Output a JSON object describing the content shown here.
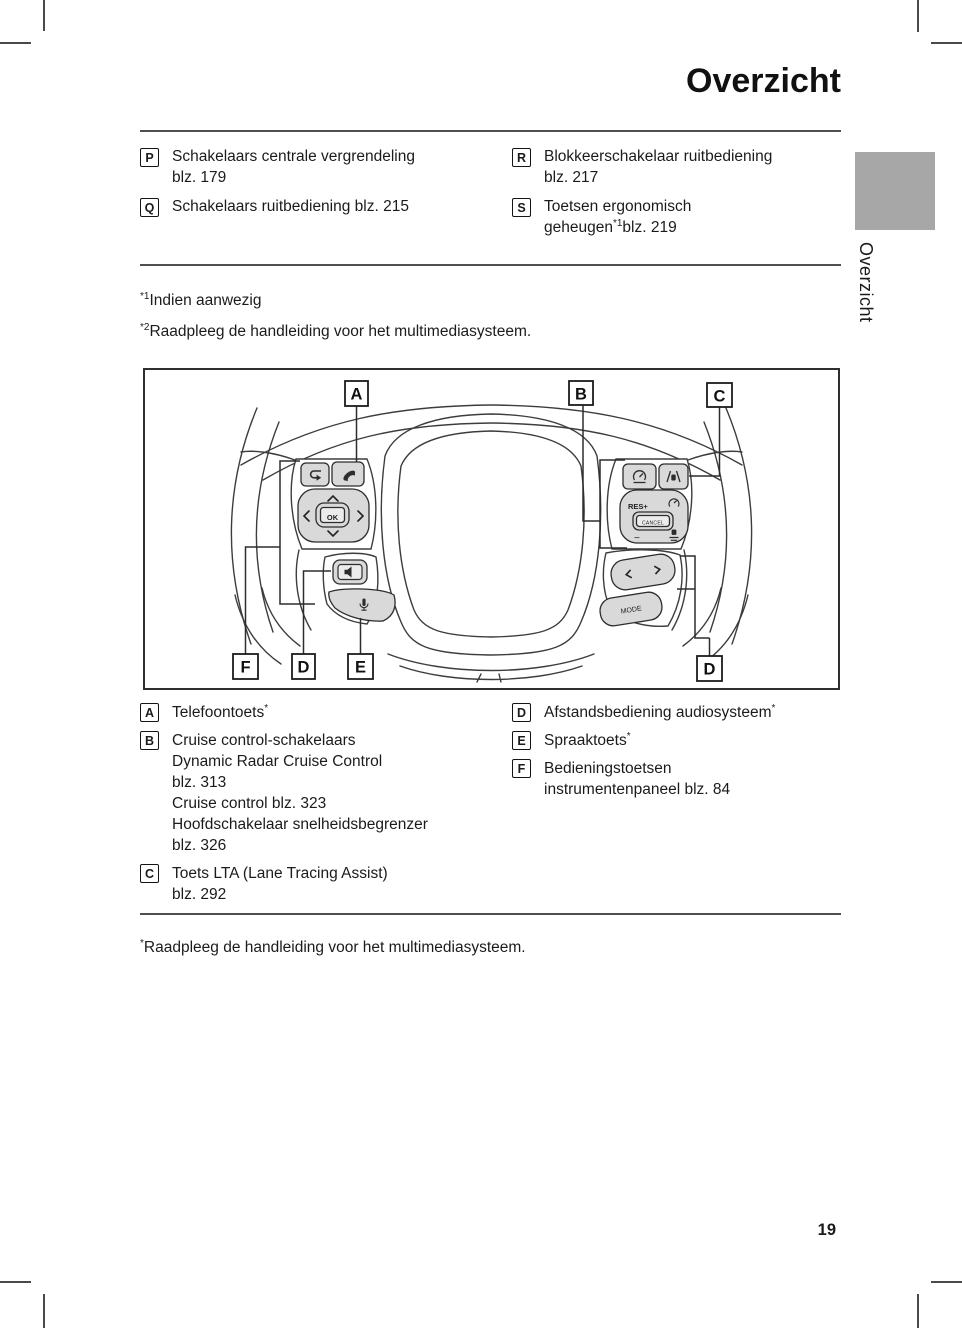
{
  "page": {
    "title": "Overzicht",
    "side_tab": "Overzicht",
    "page_number": "19"
  },
  "colors": {
    "tab_gray": "#a7a7a7",
    "button_fill": "#d9d9d9",
    "wheel_line": "#3d3d3d",
    "rule_gray": "#4f4f4f"
  },
  "top_legend": {
    "left": [
      {
        "key": "P",
        "lines": [
          [
            {
              "t": "Schakelaars centrale vergrendeling"
            }
          ],
          [
            {
              "t": "blz. 179"
            }
          ]
        ]
      },
      {
        "key": "Q",
        "lines": [
          [
            {
              "t": "Schakelaars ruitbediening blz. 215"
            }
          ]
        ]
      }
    ],
    "right": [
      {
        "key": "R",
        "lines": [
          [
            {
              "t": "Blokkeerschakelaar ruitbediening"
            }
          ],
          [
            {
              "t": "blz. 217"
            }
          ]
        ]
      },
      {
        "key": "S",
        "lines": [
          [
            {
              "t": "Toetsen ergonomisch"
            }
          ],
          [
            {
              "t": "geheugen"
            },
            {
              "sup": "*1"
            },
            {
              "t": "blz. 219"
            }
          ]
        ]
      }
    ]
  },
  "mid_notes": [
    {
      "sup": "*1",
      "t": "Indien aanwezig"
    },
    {
      "sup": "*2",
      "t": "Raadpleeg de handleiding voor het multimediasysteem."
    }
  ],
  "bottom_legend": {
    "left": [
      {
        "key": "A",
        "lines": [
          [
            {
              "t": "Telefoontoets"
            },
            {
              "sup": "*"
            }
          ]
        ]
      },
      {
        "key": "B",
        "lines": [
          [
            {
              "t": "Cruise control-schakelaars"
            }
          ],
          [
            {
              "t": "Dynamic Radar Cruise Control"
            }
          ],
          [
            {
              "t": "blz. 313"
            }
          ],
          [
            {
              "t": "Cruise control blz. 323"
            }
          ],
          [
            {
              "t": "Hoofdschakelaar snelheidsbegrenzer"
            }
          ],
          [
            {
              "t": "blz. 326"
            }
          ]
        ]
      },
      {
        "key": "C",
        "lines": [
          [
            {
              "t": "Toets LTA (Lane Tracing Assist)"
            }
          ],
          [
            {
              "t": "blz. 292"
            }
          ]
        ]
      }
    ],
    "right": [
      {
        "key": "D",
        "lines": [
          [
            {
              "t": "Afstandsbediening audiosysteem"
            },
            {
              "sup": "*"
            }
          ]
        ]
      },
      {
        "key": "E",
        "lines": [
          [
            {
              "t": "Spraaktoets"
            },
            {
              "sup": "*"
            }
          ]
        ]
      },
      {
        "key": "F",
        "lines": [
          [
            {
              "t": "Bedieningstoetsen"
            }
          ],
          [
            {
              "t": "instrumentenpaneel blz. 84"
            }
          ]
        ]
      }
    ]
  },
  "star_note": {
    "sup": "*",
    "t": "Raadpleeg de handleiding voor het multimediasysteem."
  },
  "diagram": {
    "callouts": [
      "A",
      "B",
      "C",
      "F",
      "D",
      "E",
      "D"
    ],
    "ok": "OK",
    "cancel": "CANCEL",
    "res_plus": "RES+",
    "minus": "−",
    "mode": "MODE"
  }
}
